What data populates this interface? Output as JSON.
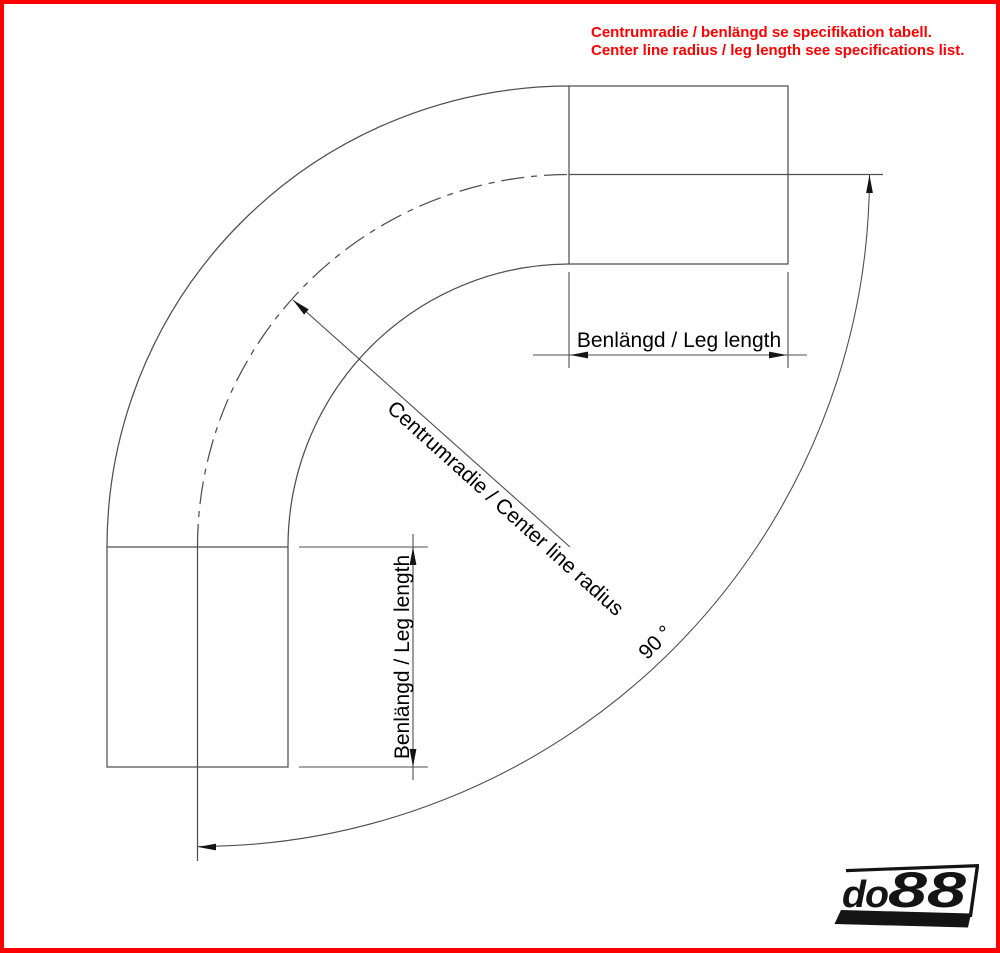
{
  "notice": {
    "line1": "Centrumradie / benlängd se specifikation tabell.",
    "line2": "Center line radius / leg length see specifications list."
  },
  "dimensions": {
    "top_leg_label": "Benlängd / Leg length",
    "left_leg_label": "Benlängd / Leg length",
    "radius_label": "Centrumradie / Center line radius",
    "angle_label": "90 °"
  },
  "logo": {
    "prefix": "do",
    "suffix": "88"
  },
  "colors": {
    "frame": "#ff0000",
    "notice_text": "#ff0000",
    "drawing_line": "#4f4f4f",
    "arrow_fill": "#141414",
    "label_text": "#000000",
    "logo": "#141414"
  }
}
